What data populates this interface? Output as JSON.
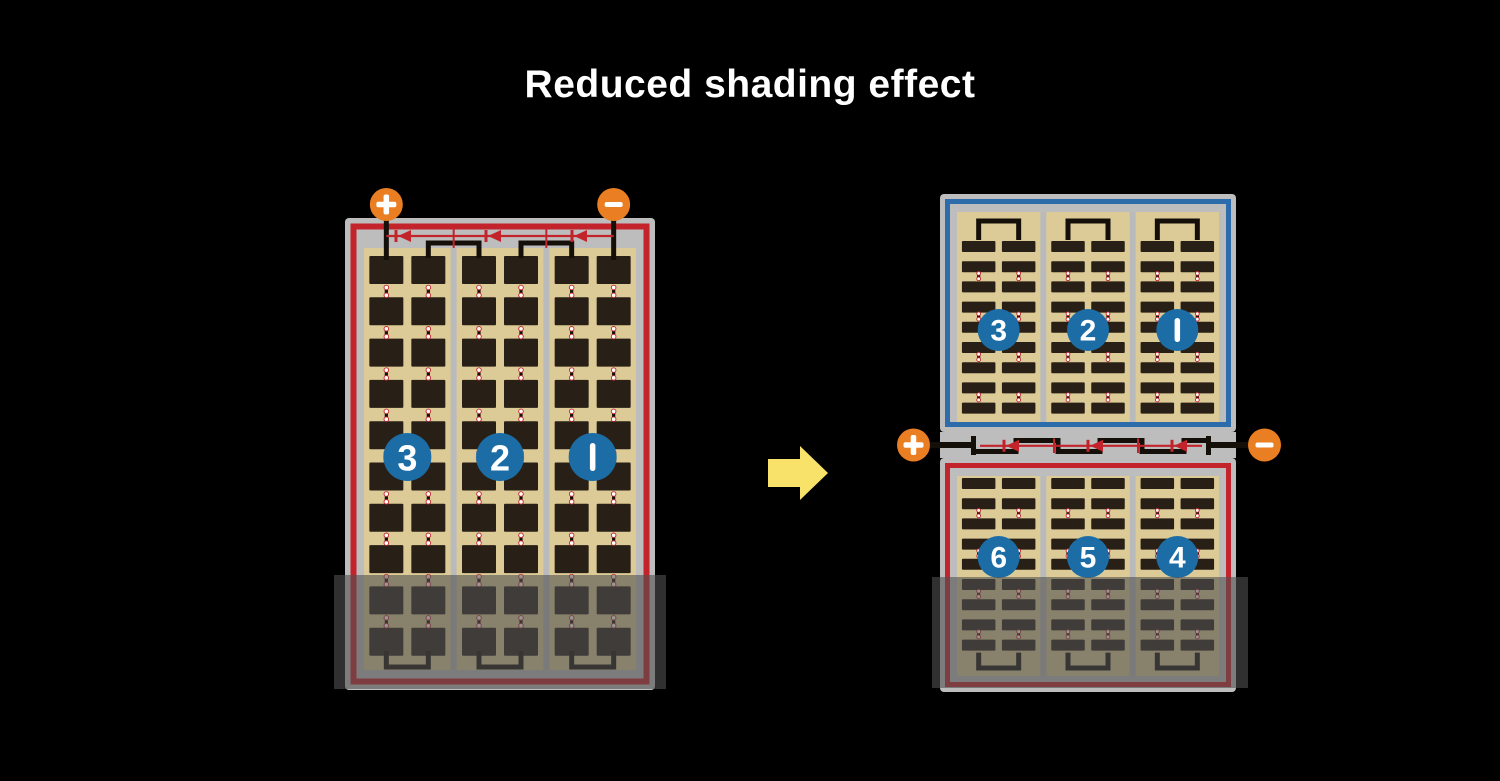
{
  "title": "Reduced shading effect",
  "colors": {
    "background": "#000000",
    "frame_gray": "#bdbdbd",
    "divider_gray": "#b9babc",
    "border_red": "#c3242b",
    "border_blue": "#2d6cab",
    "cell_field_tan": "#ddcb97",
    "cell_dark": "#281f17",
    "wire_black": "#150f0a",
    "badge_blue": "#1c6da6",
    "terminal_orange": "#ea7e22",
    "diode_red": "#c3242b",
    "arrow_yellow": "#f8e26a",
    "shade_overlay": "rgba(80,80,80,0.6)",
    "text_white": "#ffffff"
  },
  "before_module": {
    "cell_type": "full-cell",
    "strings": [
      {
        "number": "3"
      },
      {
        "number": "2"
      },
      {
        "number": "1"
      }
    ],
    "columns_per_string": 2,
    "rows": 10,
    "bypass_diodes": 3,
    "terminals": {
      "positive": "+",
      "negative": "−"
    },
    "shaded_band": true
  },
  "after_module": {
    "top_half": {
      "cell_type": "half-cell",
      "border": "blue",
      "strings": [
        {
          "number": "3"
        },
        {
          "number": "2"
        },
        {
          "number": "1"
        }
      ],
      "rows": 9,
      "shaded_band": false
    },
    "bottom_half": {
      "cell_type": "half-cell",
      "border": "red",
      "strings": [
        {
          "number": "6"
        },
        {
          "number": "5"
        },
        {
          "number": "4"
        }
      ],
      "rows": 9,
      "shaded_band": true
    },
    "bypass_diodes": 3,
    "terminals": {
      "positive": "+",
      "negative": "−"
    }
  },
  "arrow_icon": "right-arrow"
}
